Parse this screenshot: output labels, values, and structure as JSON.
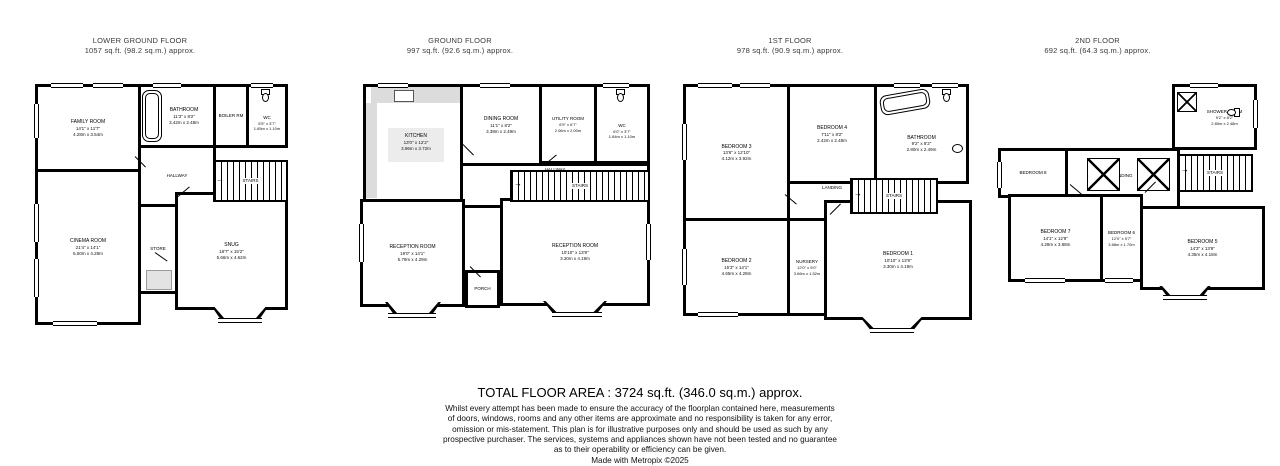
{
  "icons": {
    "stairs_arrow": "→"
  },
  "floors": [
    {
      "id": "lower-ground-floor",
      "title": "LOWER GROUND FLOOR",
      "area": "1057 sq.ft. (98.2 sq.m.) approx.",
      "rooms": {
        "family": {
          "name": "FAMILY ROOM",
          "imperial": "14'1\" x 11'7\"",
          "metric": "4.28m x 3.54m"
        },
        "bathroom": {
          "name": "BATHROOM",
          "imperial": "11'3\" x 8'2\"",
          "metric": "3.42m x 2.48m"
        },
        "boiler": {
          "name": "BOILER RM"
        },
        "wc": {
          "name": "WC",
          "imperial": "5'5\" x 3'7\"",
          "metric": "1.65m x 1.10m"
        },
        "hallway": {
          "name": "HALLWAY"
        },
        "stairs": {
          "name": "STAIRS"
        },
        "cinema": {
          "name": "CINEMA ROOM",
          "imperial": "21'4\" x 14'1\"",
          "metric": "6.50m x 4.28m"
        },
        "store": {
          "name": "STORE"
        },
        "snug": {
          "name": "SNUG",
          "imperial": "18'7\" x 15'2\"",
          "metric": "5.66m x 4.62m"
        }
      }
    },
    {
      "id": "ground-floor",
      "title": "GROUND FLOOR",
      "area": "997 sq.ft. (92.6 sq.m.) approx.",
      "rooms": {
        "kitchen": {
          "name": "KITCHEN",
          "imperial": "13'0\" x 12'2\"",
          "metric": "3.96m x 3.72m"
        },
        "dining": {
          "name": "DINING ROOM",
          "imperial": "11'1\" x 8'2\"",
          "metric": "3.38m x 2.49m"
        },
        "utility": {
          "name": "UTILITY ROOM",
          "imperial": "6'9\" x 6'7\"",
          "metric": "2.06m x 2.00m"
        },
        "wc": {
          "name": "WC",
          "imperial": "6'0\" x 3'7\"",
          "metric": "1.84m x 1.10m"
        },
        "hallway": {
          "name": "HALLWAY"
        },
        "stairs": {
          "name": "STAIRS"
        },
        "reception1": {
          "name": "RECEPTION ROOM",
          "imperial": "19'0\" x 14'1\"",
          "metric": "5.79m x 4.29m"
        },
        "porch": {
          "name": "PORCH"
        },
        "reception2": {
          "name": "RECEPTION ROOM",
          "imperial": "10'10\" x 13'9\"",
          "metric": "3.30m x 4.19m"
        }
      }
    },
    {
      "id": "first-floor",
      "title": "1ST FLOOR",
      "area": "978 sq.ft. (90.9 sq.m.) approx.",
      "rooms": {
        "bedroom3": {
          "name": "BEDROOM 3",
          "imperial": "13'6\" x 12'10\"",
          "metric": "4.12m x 3.92m"
        },
        "bedroom4": {
          "name": "BEDROOM 4",
          "imperial": "7'11\" x 8'2\"",
          "metric": "2.42m x 2.48m"
        },
        "bathroom": {
          "name": "BATHROOM",
          "imperial": "9'2\" x 8'2\"",
          "metric": "2.80m x 2.49m"
        },
        "landing": {
          "name": "LANDING"
        },
        "stairs": {
          "name": "STAIRS"
        },
        "bedroom2": {
          "name": "BEDROOM 2",
          "imperial": "15'3\" x 14'1\"",
          "metric": "4.65m x 4.28m"
        },
        "nursery": {
          "name": "NURSERY",
          "imperial": "12'0\" x 5'0\"",
          "metric": "3.66m x 1.52m"
        },
        "bedroom1": {
          "name": "BEDROOM 1",
          "imperial": "10'10\" x 13'9\"",
          "metric": "3.30m x 4.19m"
        }
      }
    },
    {
      "id": "second-floor",
      "title": "2ND FLOOR",
      "area": "692 sq.ft. (64.3 sq.m.) approx.",
      "rooms": {
        "shower": {
          "name": "SHOWER ROOM",
          "imperial": "9'2\" x 8'2\"",
          "metric": "2.80m x 2.48m"
        },
        "bedroom8": {
          "name": "BEDROOM 8"
        },
        "landing": {
          "name": "LANDING"
        },
        "stairs": {
          "name": "STAIRS"
        },
        "bedroom7": {
          "name": "BEDROOM 7",
          "imperial": "14'1\" x 12'9\"",
          "metric": "4.28m x 3.88m"
        },
        "bedroom6": {
          "name": "BEDROOM 6",
          "imperial": "12'0\" x 5'7\"",
          "metric": "3.68m x 1.70m"
        },
        "bedroom5": {
          "name": "BEDROOM 5",
          "imperial": "14'3\" x 13'9\"",
          "metric": "4.35m x 4.18m"
        }
      }
    }
  ],
  "footer": {
    "total": "TOTAL FLOOR AREA : 3724 sq.ft. (346.0 sq.m.) approx.",
    "disclaimer_lines": [
      "Whilst every attempt has been made to ensure the accuracy of the floorplan contained here, measurements",
      "of doors, windows, rooms and any other items are approximate and no responsibility is taken for any error,",
      "omission or mis-statement. This plan is for illustrative purposes only and should be used as such by any",
      "prospective purchaser. The services, systems and appliances shown have not been tested and no guarantee",
      "as to their operability or efficiency can be given."
    ],
    "credit": "Made with Metropix ©2025"
  }
}
